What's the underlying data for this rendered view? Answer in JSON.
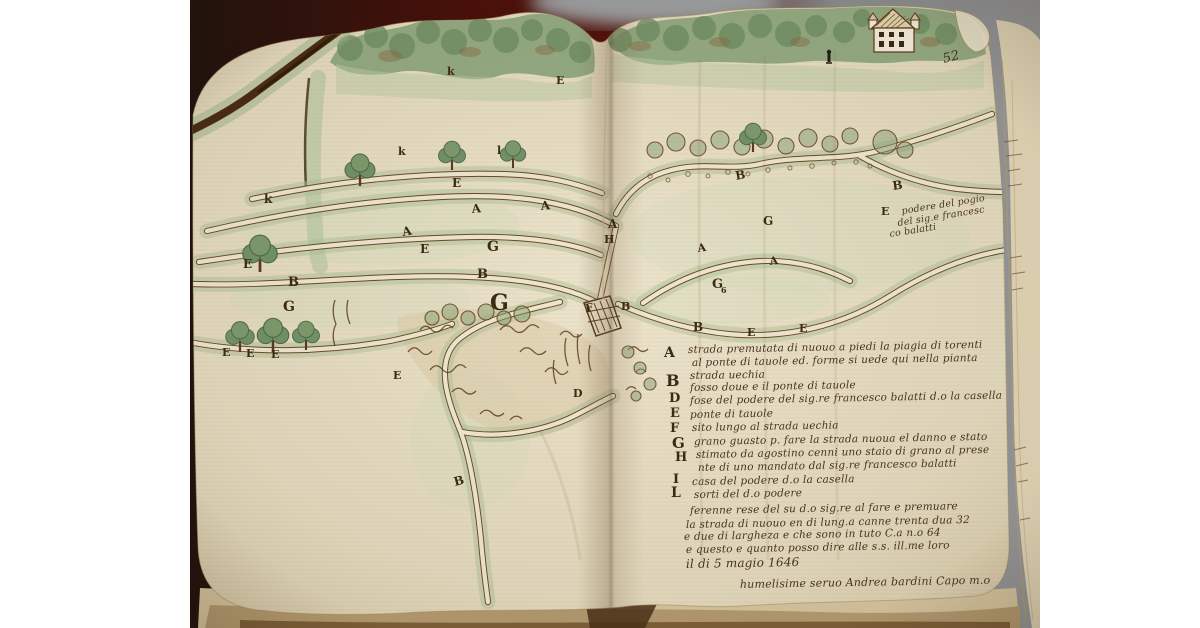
{
  "page": {
    "page_number": "52",
    "date_line": "il di 5 magio 1646",
    "signature": "humelisime seruo Andrea bardini Capo m.o"
  },
  "palette": {
    "ink-road": "#6a4a28",
    "paper-road": "#eee6cf",
    "green-halo": "#adc096",
    "ink-letter": "#3b2a14",
    "ink-script": "#4a3420",
    "paper": "#e9e0c6",
    "green-wash": "#9cb489",
    "background-dark": "#4a100a"
  },
  "texts": {
    "map_letters": [
      {
        "t": "k",
        "x": 447,
        "y": 75,
        "s": 11
      },
      {
        "t": "E",
        "x": 556,
        "y": 84,
        "s": 11
      },
      {
        "t": "k",
        "x": 398,
        "y": 155,
        "s": 11
      },
      {
        "t": "l",
        "x": 497,
        "y": 154,
        "s": 11
      },
      {
        "t": "k",
        "x": 264,
        "y": 203,
        "s": 12
      },
      {
        "t": "E",
        "x": 452,
        "y": 187,
        "s": 12
      },
      {
        "t": "A",
        "x": 472,
        "y": 213,
        "s": 12,
        "r": -5
      },
      {
        "t": "A",
        "x": 541,
        "y": 210,
        "s": 12,
        "r": -5
      },
      {
        "t": "A",
        "x": 608,
        "y": 228,
        "s": 12
      },
      {
        "t": "H",
        "x": 604,
        "y": 243,
        "s": 11
      },
      {
        "t": "A",
        "x": 403,
        "y": 236,
        "s": 12,
        "r": -10
      },
      {
        "t": "E",
        "x": 420,
        "y": 253,
        "s": 12
      },
      {
        "t": "E",
        "x": 243,
        "y": 268,
        "s": 12
      },
      {
        "t": "B",
        "x": 288,
        "y": 286,
        "s": 13
      },
      {
        "t": "G",
        "x": 487,
        "y": 251,
        "s": 14
      },
      {
        "t": "B",
        "x": 477,
        "y": 278,
        "s": 13
      },
      {
        "t": "G",
        "x": 490,
        "y": 310,
        "s": 22
      },
      {
        "t": "G",
        "x": 283,
        "y": 311,
        "s": 14
      },
      {
        "t": "E",
        "x": 222,
        "y": 356,
        "s": 11
      },
      {
        "t": "E",
        "x": 246,
        "y": 357,
        "s": 11
      },
      {
        "t": "E",
        "x": 271,
        "y": 358,
        "s": 11
      },
      {
        "t": "E",
        "x": 393,
        "y": 379,
        "s": 11
      },
      {
        "t": "D",
        "x": 573,
        "y": 397,
        "s": 11
      },
      {
        "t": "B",
        "x": 455,
        "y": 486,
        "s": 12,
        "r": -15
      },
      {
        "t": "F",
        "x": 586,
        "y": 312,
        "s": 11,
        "r": -10
      },
      {
        "t": "B",
        "x": 621,
        "y": 310,
        "s": 11
      },
      {
        "t": "G",
        "x": 712,
        "y": 288,
        "s": 13
      },
      {
        "t": "6",
        "x": 721,
        "y": 293,
        "s": 8
      },
      {
        "t": "B",
        "x": 736,
        "y": 180,
        "s": 12,
        "r": -10
      },
      {
        "t": "B",
        "x": 893,
        "y": 190,
        "s": 12,
        "r": -8
      },
      {
        "t": "G",
        "x": 763,
        "y": 225,
        "s": 12
      },
      {
        "t": "E",
        "x": 881,
        "y": 215,
        "s": 11
      },
      {
        "t": "A",
        "x": 698,
        "y": 252,
        "s": 11,
        "r": -8
      },
      {
        "t": "A",
        "x": 770,
        "y": 265,
        "s": 11,
        "r": -8
      },
      {
        "t": "B",
        "x": 693,
        "y": 331,
        "s": 12
      },
      {
        "t": "E",
        "x": 747,
        "y": 336,
        "s": 11
      },
      {
        "t": "E",
        "x": 799,
        "y": 332,
        "s": 11
      }
    ],
    "legend_letters": [
      {
        "t": "A",
        "x": 664,
        "y": 357,
        "s": 14
      },
      {
        "t": "B",
        "x": 666,
        "y": 386,
        "s": 16
      },
      {
        "t": "D",
        "x": 669,
        "y": 402,
        "s": 13
      },
      {
        "t": "E",
        "x": 670,
        "y": 417,
        "s": 13
      },
      {
        "t": "F",
        "x": 670,
        "y": 432,
        "s": 13
      },
      {
        "t": "G",
        "x": 672,
        "y": 448,
        "s": 15
      },
      {
        "t": "H",
        "x": 675,
        "y": 461,
        "s": 13
      },
      {
        "t": "I",
        "x": 673,
        "y": 483,
        "s": 13
      },
      {
        "t": "L",
        "x": 671,
        "y": 497,
        "s": 14
      }
    ],
    "legend_lines": [
      {
        "t": "strada premutata di nuouo a piedi la piagia di torenti",
        "x": 688,
        "y": 353,
        "s": 10.5,
        "r": -1
      },
      {
        "t": "al ponte di tauole ed. forme si uede qui nella pianta",
        "x": 692,
        "y": 366,
        "s": 10.5,
        "r": -1
      },
      {
        "t": "strada uechia",
        "x": 690,
        "y": 379,
        "s": 10.5,
        "r": -1
      },
      {
        "t": "fosso doue e il ponte di tauole",
        "x": 690,
        "y": 391,
        "s": 10.5,
        "r": -1
      },
      {
        "t": "fose del podere del sig.re francesco balatti d.o la casella",
        "x": 690,
        "y": 404,
        "s": 10.5,
        "r": -1
      },
      {
        "t": "ponte di tauole",
        "x": 690,
        "y": 418,
        "s": 10.5,
        "r": -1
      },
      {
        "t": "sito lungo al strada uechia",
        "x": 692,
        "y": 431,
        "s": 10.5,
        "r": -1
      },
      {
        "t": "grano guasto p. fare la strada nuoua el danno e stato",
        "x": 694,
        "y": 445,
        "s": 10.5,
        "r": -1
      },
      {
        "t": "stimato da agostino cenni uno staio di grano al prese",
        "x": 696,
        "y": 458,
        "s": 10.5,
        "r": -1
      },
      {
        "t": "nte di uno mandato dal sig.re francesco balatti",
        "x": 698,
        "y": 471,
        "s": 10.5,
        "r": -1
      },
      {
        "t": "casa del podere d.o la casella",
        "x": 692,
        "y": 485,
        "s": 10.5,
        "r": -1
      },
      {
        "t": "sorti del d.o podere",
        "x": 694,
        "y": 498,
        "s": 10.5,
        "r": -1
      },
      {
        "t": "ferenne rese del su d.o sig.re al fare e premuare",
        "x": 690,
        "y": 514,
        "s": 10.5,
        "r": -1
      },
      {
        "t": "la strada di nuouo en di lung.a canne trenta dua 32",
        "x": 686,
        "y": 528,
        "s": 10.5,
        "r": -1
      },
      {
        "t": "e due di largheza e che sono in tuto C.a n.o 64",
        "x": 684,
        "y": 540,
        "s": 10.5,
        "r": -1
      },
      {
        "t": "e questo e quanto posso dire alle s.s. ill.me loro",
        "x": 686,
        "y": 553,
        "s": 10.5,
        "r": -1
      },
      {
        "t": "il di 5 magio 1646",
        "x": 686,
        "y": 568,
        "s": 12,
        "r": -1
      },
      {
        "t": "humelisime seruo Andrea bardini Capo m.o",
        "x": 740,
        "y": 588,
        "s": 11,
        "r": -1
      }
    ],
    "annotations": [
      {
        "t": "podere del pogio",
        "x": 902,
        "y": 214,
        "s": 9.5,
        "r": -9
      },
      {
        "t": "del sig.e francesc",
        "x": 898,
        "y": 226,
        "s": 9.5,
        "r": -9
      },
      {
        "t": "co balatti",
        "x": 890,
        "y": 237,
        "s": 9.5,
        "r": -9
      },
      {
        "t": "52",
        "x": 944,
        "y": 63,
        "s": 13,
        "r": -15
      }
    ]
  }
}
